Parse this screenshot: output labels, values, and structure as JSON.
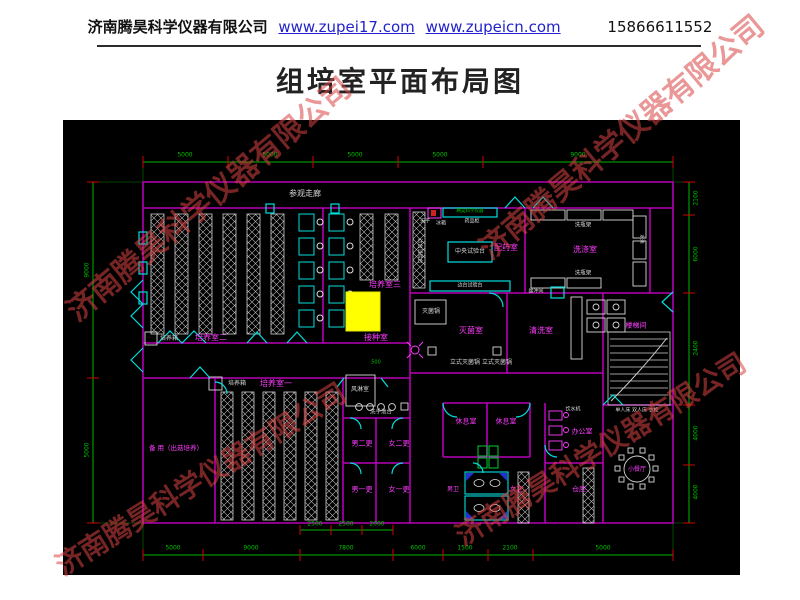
{
  "header": {
    "company": "济南腾昊科学仪器有限公司",
    "link1": "www.zupei17.com",
    "link2": "www.zupeicn.com",
    "phone": "15866611552"
  },
  "title": "组培室平面布局图",
  "watermark": {
    "text": "济南腾昊科学仪器有限公司",
    "color": "#d94343"
  },
  "plan": {
    "labels": [
      {
        "n": "visit-corridor",
        "t": "参观走廊",
        "x": 242,
        "y": 74,
        "c": "w",
        "s": 8
      },
      {
        "n": "culture-room-2",
        "t": "培养室二",
        "x": 148,
        "y": 218,
        "c": "m",
        "s": 8
      },
      {
        "n": "culture-room-3",
        "t": "培养室三",
        "x": 322,
        "y": 165,
        "c": "m",
        "s": 8
      },
      {
        "n": "culture-room-1",
        "t": "培养室一",
        "x": 213,
        "y": 264,
        "c": "m",
        "s": 8
      },
      {
        "n": "incubator-a",
        "t": "培养箱",
        "x": 106,
        "y": 219,
        "c": "w",
        "s": 6
      },
      {
        "n": "incubator-b",
        "t": "培养箱",
        "x": 174,
        "y": 264,
        "c": "w",
        "s": 6
      },
      {
        "n": "inoculation-room",
        "t": "接种室",
        "x": 313,
        "y": 218,
        "c": "m",
        "s": 8
      },
      {
        "n": "sterilize-room",
        "t": "灭菌室",
        "x": 408,
        "y": 211,
        "c": "m",
        "s": 8
      },
      {
        "n": "washing-room",
        "t": "清洗室",
        "x": 478,
        "y": 211,
        "c": "m",
        "s": 8
      },
      {
        "n": "stair-room",
        "t": "楼梯间",
        "x": 573,
        "y": 206,
        "c": "m",
        "s": 7
      },
      {
        "n": "media-prep-room",
        "t": "配药室",
        "x": 443,
        "y": 128,
        "c": "m",
        "s": 8
      },
      {
        "n": "rinse-room",
        "t": "洗涤室",
        "x": 522,
        "y": 130,
        "c": "m",
        "s": 8
      },
      {
        "n": "central-bench",
        "t": "中央试验台",
        "x": 407,
        "y": 132,
        "c": "w",
        "s": 6
      },
      {
        "n": "autoclaves",
        "t": "立式灭菌锅 立式灭菌锅",
        "x": 418,
        "y": 243,
        "c": "w",
        "s": 6
      },
      {
        "n": "sterilizer-pot",
        "t": "灭菌锅",
        "x": 368,
        "y": 192,
        "c": "w",
        "s": 6
      },
      {
        "n": "air-shower",
        "t": "风淋室",
        "x": 297,
        "y": 270,
        "c": "w",
        "s": 6
      },
      {
        "n": "hand-sink-row",
        "t": "洗手池台",
        "x": 318,
        "y": 293,
        "c": "w",
        "s": 5.5
      },
      {
        "n": "spare-room",
        "t": "备 用（出菇培养）",
        "x": 113,
        "y": 328,
        "c": "m",
        "s": 6.5
      },
      {
        "n": "change-m2",
        "t": "男二更",
        "x": 299,
        "y": 324,
        "c": "m",
        "s": 7
      },
      {
        "n": "change-f2",
        "t": "女二更",
        "x": 336,
        "y": 324,
        "c": "m",
        "s": 7
      },
      {
        "n": "change-m1",
        "t": "男一更",
        "x": 299,
        "y": 370,
        "c": "m",
        "s": 7
      },
      {
        "n": "change-f1",
        "t": "女一更",
        "x": 336,
        "y": 370,
        "c": "m",
        "s": 7
      },
      {
        "n": "rest-room-1",
        "t": "休息室",
        "x": 403,
        "y": 302,
        "c": "m",
        "s": 7
      },
      {
        "n": "rest-room-2",
        "t": "休息室",
        "x": 443,
        "y": 302,
        "c": "m",
        "s": 7
      },
      {
        "n": "wc-men",
        "t": "男卫",
        "x": 390,
        "y": 370,
        "c": "m",
        "s": 6
      },
      {
        "n": "wc-women",
        "t": "女卫",
        "x": 453,
        "y": 370,
        "c": "m",
        "s": 6
      },
      {
        "n": "office",
        "t": "办公室",
        "x": 519,
        "y": 312,
        "c": "m",
        "s": 7
      },
      {
        "n": "storage",
        "t": "仓库",
        "x": 516,
        "y": 370,
        "c": "m",
        "s": 7
      },
      {
        "n": "dining-room",
        "t": "小餐厅",
        "x": 574,
        "y": 350,
        "c": "m",
        "s": 6
      },
      {
        "n": "furniture-note",
        "t": "单人床 双人床 衣柜",
        "x": 574,
        "y": 291,
        "c": "w",
        "s": 5
      },
      {
        "n": "water-dispenser",
        "t": "饮水机",
        "x": 510,
        "y": 290,
        "c": "w",
        "s": 5
      },
      {
        "n": "balance",
        "t": "天平",
        "x": 362,
        "y": 102,
        "c": "w",
        "s": 5
      },
      {
        "n": "fridge",
        "t": "冰箱",
        "x": 378,
        "y": 104,
        "c": "w",
        "s": 5
      },
      {
        "n": "medicine-cabinet",
        "t": "药品柜",
        "x": 409,
        "y": 102,
        "c": "w",
        "s": 5
      },
      {
        "n": "bottle-rack-1",
        "t": "洗瓶架",
        "x": 520,
        "y": 106,
        "c": "w",
        "s": 5.5
      },
      {
        "n": "bottle-rack-2",
        "t": "洗瓶架",
        "x": 520,
        "y": 154,
        "c": "w",
        "s": 5.5
      },
      {
        "n": "side-bench-v",
        "t": "边台试验台",
        "x": 356,
        "y": 131,
        "c": "w",
        "s": 5,
        "r": 90
      },
      {
        "n": "side-bench-h",
        "t": "边台试验台",
        "x": 407,
        "y": 166,
        "c": "w",
        "s": 5
      },
      {
        "n": "buffer-box",
        "t": "缓冲间",
        "x": 473,
        "y": 172,
        "c": "w",
        "s": 5
      },
      {
        "n": "sink-v",
        "t": "水池",
        "x": 577,
        "y": 119,
        "c": "w",
        "s": 4.5,
        "r": 90
      },
      {
        "n": "banner-strip",
        "t": "腾昊科学仪器",
        "x": 407,
        "y": 92,
        "c": "g",
        "s": 4.5
      },
      {
        "n": "inner-dim-500",
        "t": "500",
        "x": 313,
        "y": 243,
        "c": "g",
        "s": 5
      }
    ],
    "dims": {
      "top": [
        {
          "p": 122,
          "t": "5000"
        },
        {
          "p": 207,
          "t": "5000"
        },
        {
          "p": 292,
          "t": "5000"
        },
        {
          "p": 377,
          "t": "5000"
        },
        {
          "p": 515,
          "t": "9000"
        }
      ],
      "bottom": [
        {
          "p": 110,
          "t": "5000"
        },
        {
          "p": 188,
          "t": "9000"
        },
        {
          "p": 283,
          "t": "7800"
        },
        {
          "p": 355,
          "t": "6000"
        },
        {
          "p": 402,
          "t": "1500"
        },
        {
          "p": 447,
          "t": "2100"
        },
        {
          "p": 540,
          "t": "5000"
        }
      ],
      "sub": [
        {
          "p": 252,
          "t": "2500"
        },
        {
          "p": 283,
          "t": "2500"
        },
        {
          "p": 314,
          "t": "2000"
        }
      ],
      "right": [
        {
          "p": 78,
          "t": "2100"
        },
        {
          "p": 134,
          "t": "6000"
        },
        {
          "p": 228,
          "t": "2400"
        },
        {
          "p": 313,
          "t": "4000"
        },
        {
          "p": 372,
          "t": "4000"
        }
      ],
      "left": [
        {
          "p": 150,
          "t": "9000"
        },
        {
          "p": 330,
          "t": "5000"
        }
      ]
    }
  }
}
